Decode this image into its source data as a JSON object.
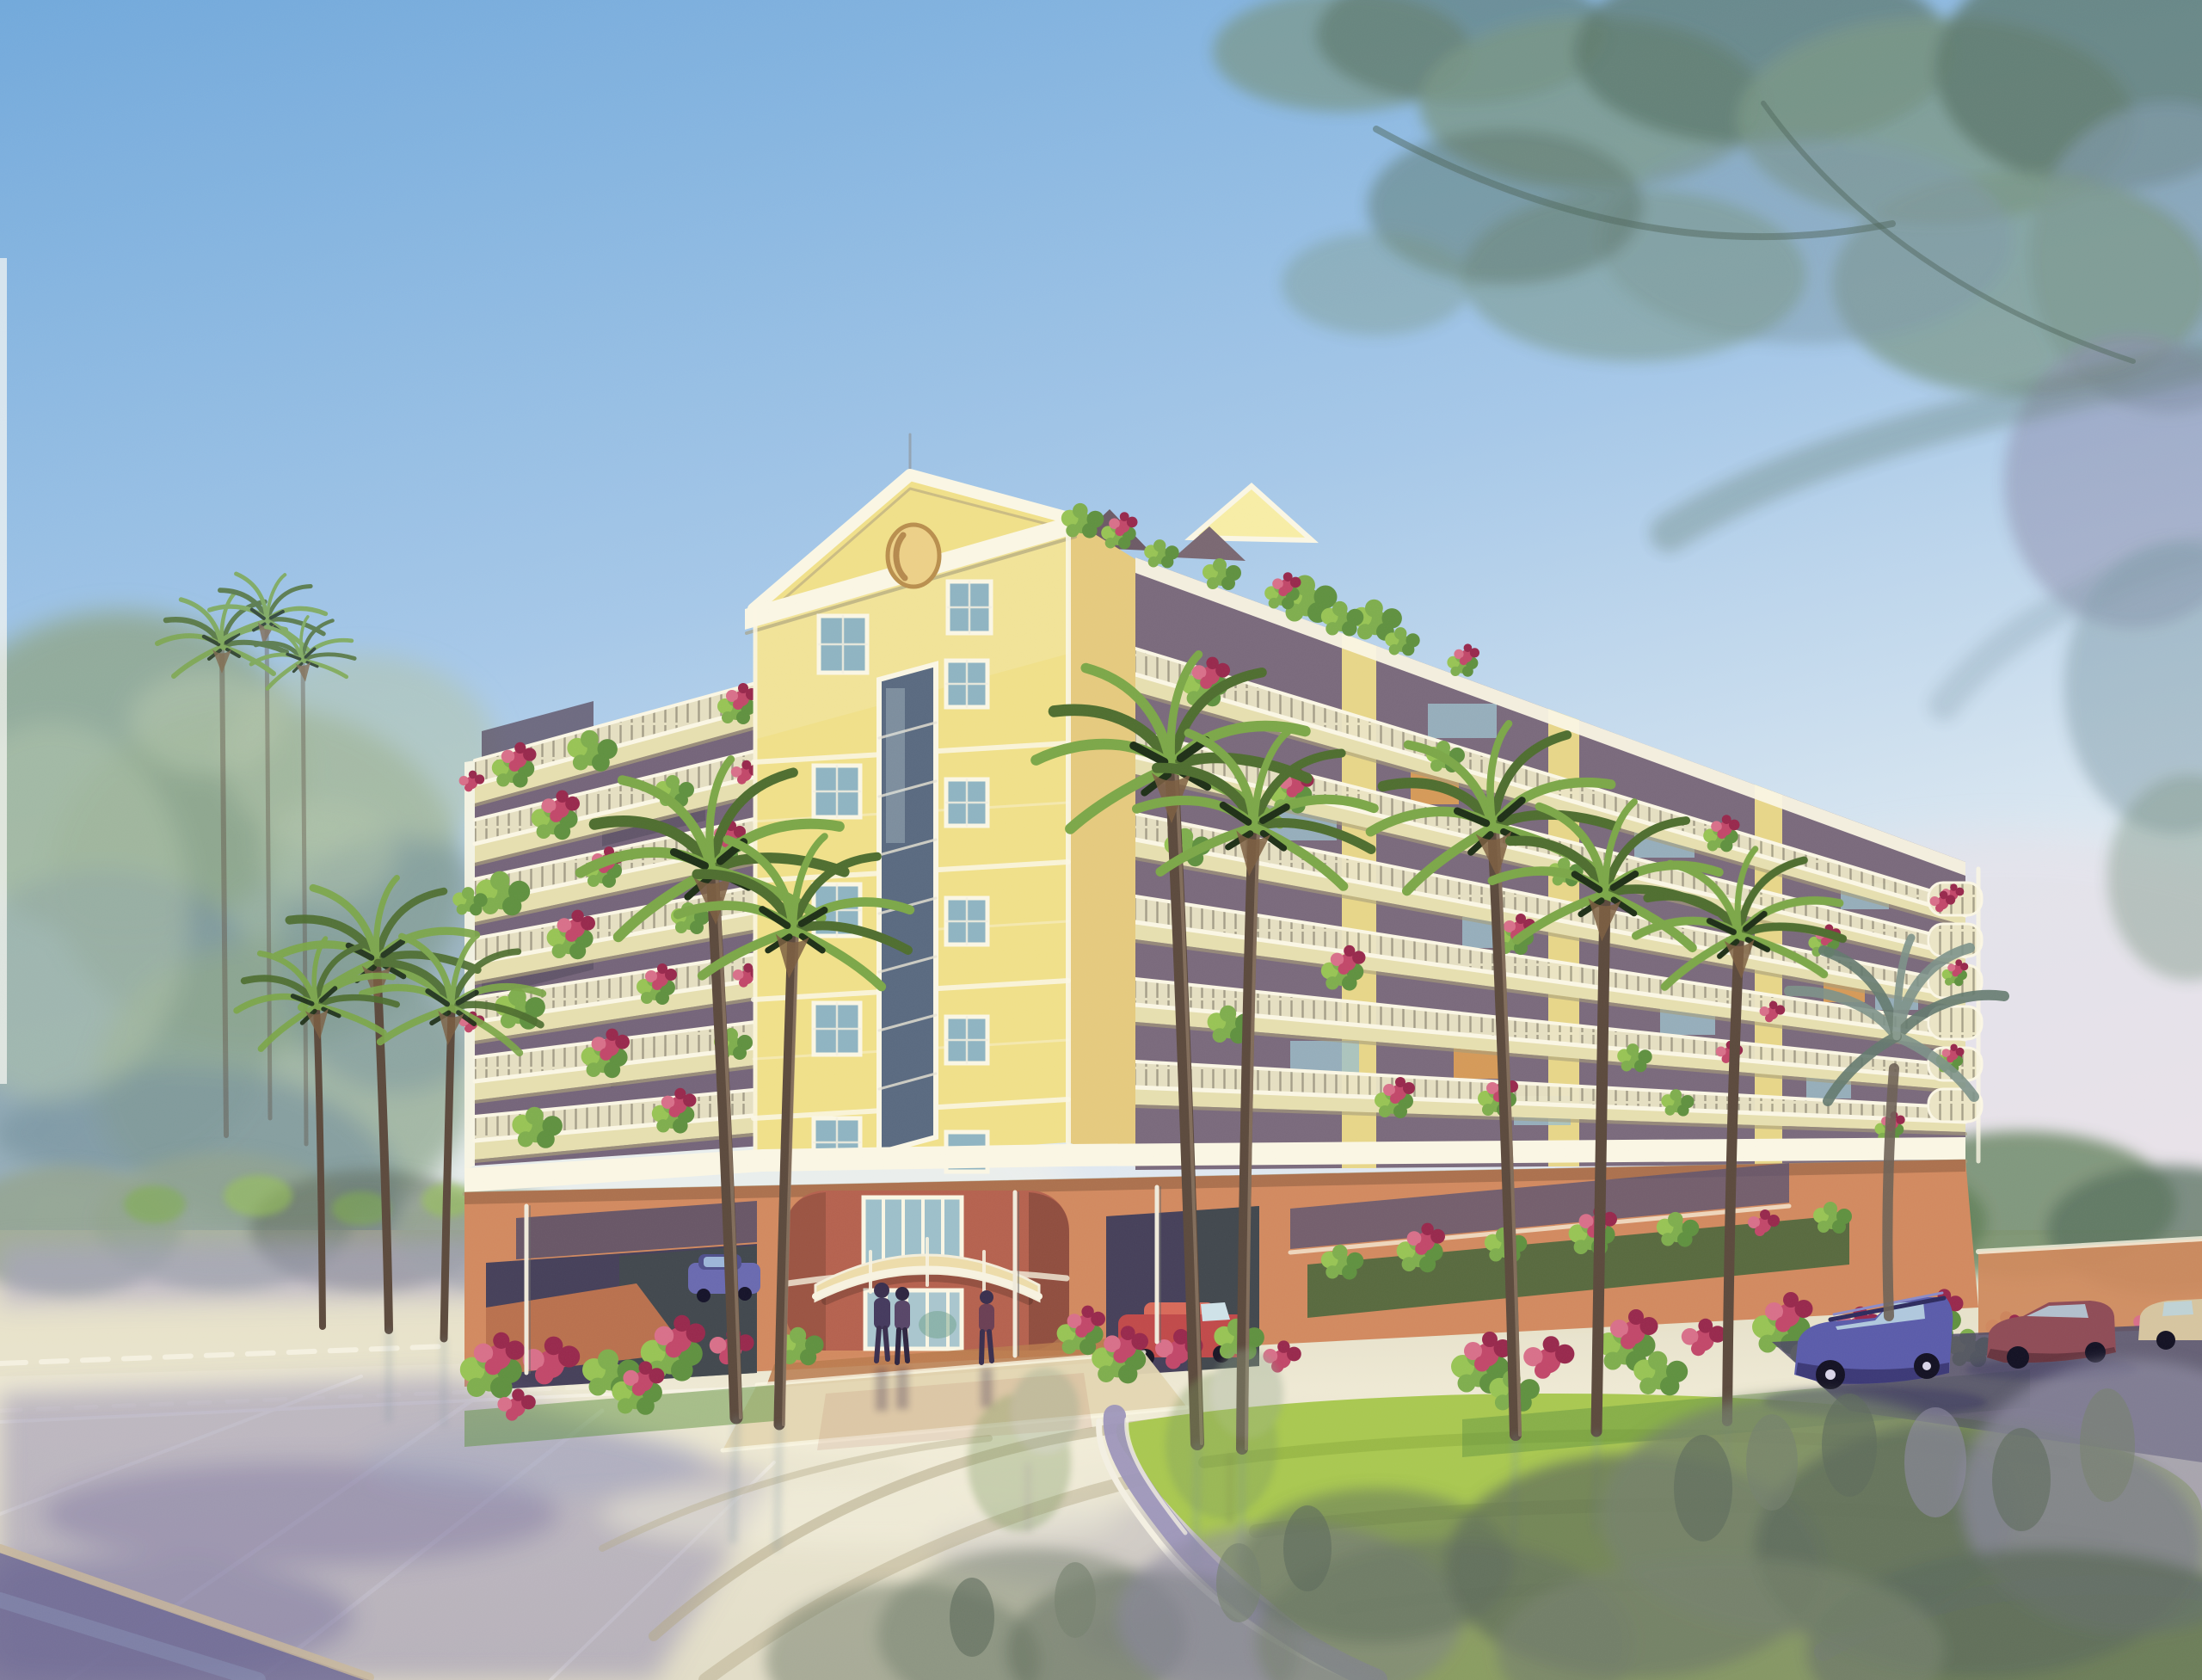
{
  "scene": {
    "type": "watercolor architectural rendering",
    "description": "Eight-story yellow condominium with a pedimented corner tower, wrap-around balconies overflowing with bougainvillea, a terracotta parking garage base, a curved cream entry awning, palm trees, a circular lawn driveway, parked cars, pedestrians and wet reflective pavement under overhanging trees.",
    "objects": [
      "blue sky wash",
      "overhanging tree canopy",
      "large left tree mass",
      "distant treeline with purple haze",
      "condominium building",
      "pediment tower with oval medallion",
      "left balcony wing",
      "right balcony wing",
      "rooftop terrace plants",
      "balcony flower boxes",
      "parking garage base",
      "entrance rotunda with barrel awning",
      "glass entry doors",
      "three pedestrians",
      "blue station wagon",
      "maroon sedan",
      "tan car",
      "red car in garage",
      "blue car in garage",
      "palm trees",
      "gray distant palm",
      "circular lawn island with curb",
      "red flower beds",
      "wet pavement reflections",
      "tire track arcs",
      "foreground shrubs",
      "garden wall"
    ]
  },
  "palette": {
    "sky_top": "#72a9db",
    "sky_mid": "#a6c8e8",
    "sky_low": "#dce8f1",
    "sky_haze": "#ece6eb",
    "canopy_green": "#78937f",
    "canopy_dark": "#57705f",
    "canopy_blue": "#7e97a4",
    "canopy_purple": "#8c8dac",
    "branch": "#4a5f51",
    "tree_left": "#8fa78f",
    "tree_left_light": "#b2c5ac",
    "tree_left_shadow": "#79939e",
    "treeline": "#93a48e",
    "haze_purple": "#a7a1c6",
    "tree_right": "#5f7f58",
    "facade_yellow": "#f0e08a",
    "facade_light": "#f7eda6",
    "facade_shade": "#e5ca7e",
    "trim_white": "#faf6e4",
    "slab_cream": "#e6dfb0",
    "slab_shadow": "#a69d7a",
    "recess_dark": "#75657a",
    "recess_darker": "#5e5366",
    "railing_light": "#ebe5c6",
    "railing_line": "#8f8a74",
    "glass_blue": "#9dbfca",
    "glass_dark": "#5a6a80",
    "window_glass": "#8fb4c2",
    "terracotta": "#d28a60",
    "terracotta_dark": "#b9714e",
    "rotunda_red": "#b5624f",
    "awning_cream": "#eddcaa",
    "garage_dark": "#46405a",
    "garage_green": "#3f4f46",
    "flower_red": "#c2486a",
    "flower_deep": "#98294d",
    "flower_pink": "#d8708a",
    "leaf_green": "#7fae4e",
    "leaf_dark": "#609140",
    "leaf_bright": "#98c455",
    "palm_green": "#7ca749",
    "palm_dark": "#4f6e30",
    "palm_accent": "#1f3018",
    "palm_trunk": "#5c4a3d",
    "palm_trunk_light": "#9b8670",
    "palm_skirt": "#7d5f42",
    "palm_gray": "#7e938a",
    "palm_gray_dark": "#647a6f",
    "lawn": "#a9c851",
    "lawn_dark": "#8fae3f",
    "pavement": "#e9e4cb",
    "pavement_light": "#f2eed9",
    "wet_purple": "#8d87ae",
    "wet_deep": "#7a74a0",
    "curb_purple": "#9d96bb",
    "curb_white": "#f3efe2",
    "tirepath": "#b4a988",
    "car_blue": "#5b5caa",
    "car_blue_dark": "#34316a",
    "car_maroon": "#8f4c57",
    "car_tan": "#d6c5a0",
    "car_red": "#c14a4a",
    "car_window": "#b9d4e2",
    "figure_dark": "#3a2f4e",
    "figure_maroon": "#6b3f54",
    "bush_gray": "#76816e",
    "bush_dark": "#5e6b5c",
    "bush_purple": "#8c89a0",
    "wall_orange": "#cf8a5e",
    "asphalt": "#4f4a66"
  }
}
